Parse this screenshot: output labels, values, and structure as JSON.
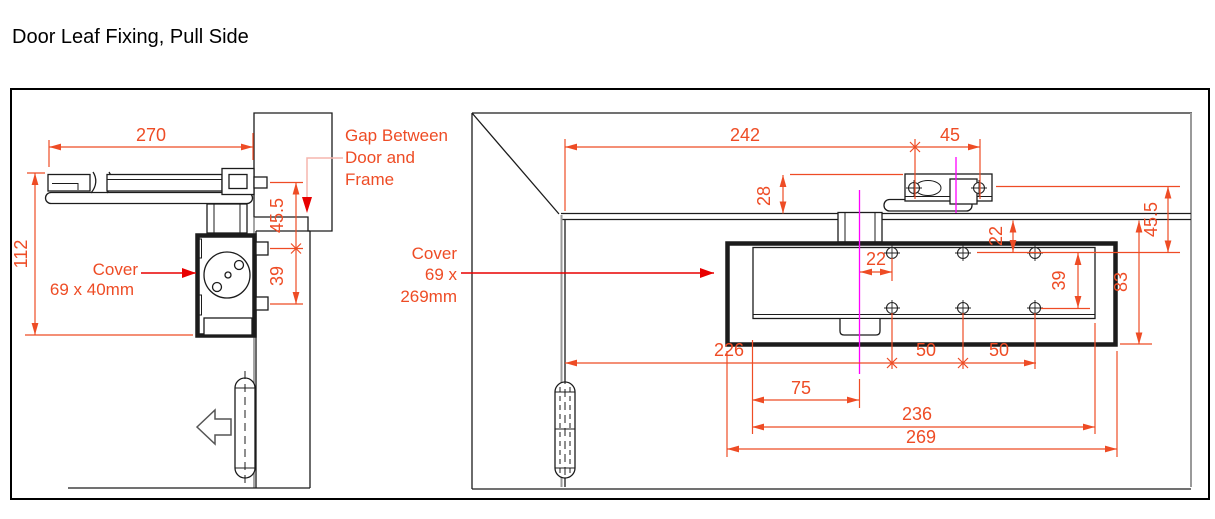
{
  "title": "Door Leaf Fixing, Pull Side",
  "colors": {
    "line": "#1c1c1c",
    "grey_edge": "#9a9a9a",
    "dimension": "#ee4c25",
    "leader": "#e80000",
    "leader_soft": "#f5b5ae",
    "centerline": "#ff00ff"
  },
  "left_view": {
    "dim_width": "270",
    "dim_height": "112",
    "dim_top_fixing": "45.5",
    "dim_fixing_spacing": "39",
    "cover_label_line1": "Cover",
    "cover_label_line2": "69 x 40mm",
    "gap_label_line1": "Gap Between",
    "gap_label_line2": "Door and",
    "gap_label_line3": "Frame"
  },
  "right_view": {
    "dim_centre_from_hinge": "242",
    "dim_shoe_screws": "45",
    "dim_shoe_height": "28",
    "dim_top_fixing": "45.5",
    "dim_screw_row_top": "22",
    "dim_screw_from_centre": "22",
    "dim_screw_rows": "39",
    "dim_body_height": "83",
    "dim_cover_from_hinge": "226",
    "dim_screw_pitch_a": "50",
    "dim_screw_pitch_b": "50",
    "dim_centre_from_cover_edge": "75",
    "dim_screw_span": "236",
    "dim_cover_length": "269",
    "cover_label_line1": "Cover",
    "cover_label_line2": "69 x",
    "cover_label_line3": "269mm"
  }
}
